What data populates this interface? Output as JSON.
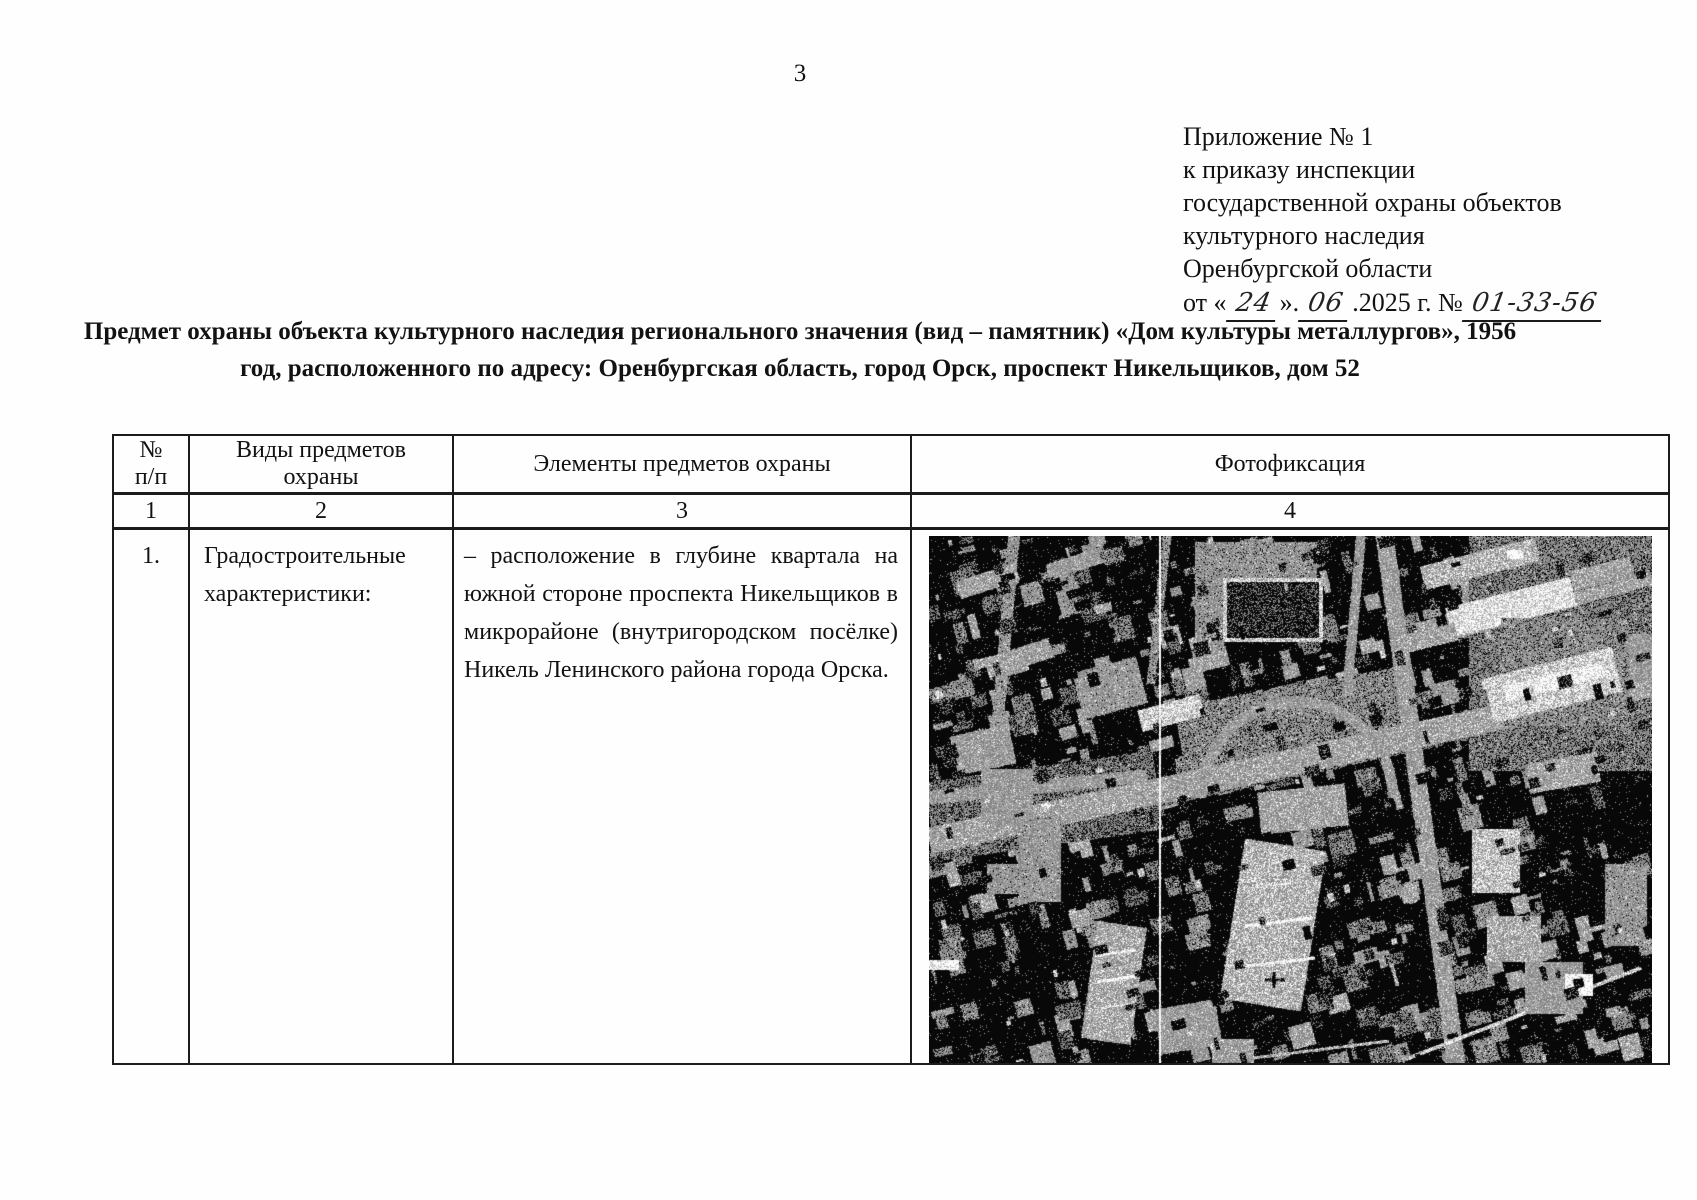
{
  "page": {
    "number": "3"
  },
  "header_block": {
    "lines": [
      "Приложение № 1",
      "к приказу инспекции",
      "государственной охраны объектов",
      "культурного наследия",
      "Оренбургской области"
    ],
    "date_line": {
      "pre": "от «",
      "day": "24",
      "mid1": "».",
      "month": "06",
      "mid2": ".2025 г. №",
      "number": "01-33-56"
    }
  },
  "title": {
    "line1": "Предмет охраны объекта культурного наследия регионального значения (вид – памятник) «Дом культуры металлургов»,  1956",
    "line2": "год, расположенного по адресу: Оренбургская область, город Орск, проспект Никельщиков, дом 52"
  },
  "table": {
    "headers": {
      "col1_line1": "№",
      "col1_line2": "п/п",
      "col2_line1": "Виды предметов",
      "col2_line2": "охраны",
      "col3": "Элементы предметов охраны",
      "col4": "Фотофиксация"
    },
    "numbers": [
      "1",
      "2",
      "3",
      "4"
    ],
    "row": {
      "num": "1.",
      "kind_lines": [
        "Градостроительные",
        "характеристики:"
      ],
      "element_lines": [
        "– расположение в глубине квартала на",
        "южной стороне проспекта Никельщиков в",
        "микрорайоне (внутригородском посёлке)",
        "Никель Ленинского района города Орска."
      ]
    }
  },
  "photo": {
    "width": 723,
    "height": 528,
    "seed": 987654321,
    "base": 0,
    "noise": 130,
    "salt": 0.05,
    "levels": [
      8,
      133,
      182,
      250
    ],
    "thresholds": [
      70,
      148,
      205
    ],
    "scanline_x": 230,
    "texture_passes": [
      {
        "stage": "under",
        "count": 560,
        "min": 3,
        "max": 26,
        "cmin": 70,
        "cmax": 160,
        "rot": -15
      },
      {
        "stage": "over",
        "count": 260,
        "min": 3,
        "max": 16,
        "cmin": 0,
        "cmax": 70,
        "rot": -15
      },
      {
        "stage": "over",
        "count": 70,
        "min": 2,
        "max": 9,
        "cmin": 150,
        "cmax": 205,
        "rot": -15
      }
    ],
    "features": [
      {
        "t": "rect",
        "x": 540,
        "y": 0,
        "w": 183,
        "h": 235,
        "r": 0,
        "c": 100
      },
      {
        "t": "rect",
        "x": 250,
        "y": 150,
        "w": 230,
        "h": 80,
        "r": -10,
        "c": 110
      },
      {
        "t": "rect",
        "x": 0,
        "y": 230,
        "w": 230,
        "h": 80,
        "r": -8,
        "c": 90
      },
      {
        "t": "line",
        "x1": 0,
        "y1": 318,
        "x2": 723,
        "y2": 161,
        "w": 6,
        "c": 95
      },
      {
        "t": "line",
        "x1": 0,
        "y1": 305,
        "x2": 723,
        "y2": 148,
        "w": 26,
        "c": 150
      },
      {
        "t": "line",
        "x1": 455,
        "y1": -5,
        "x2": 528,
        "y2": 533,
        "w": 18,
        "c": 145
      },
      {
        "t": "line",
        "x1": 85,
        "y1": 0,
        "x2": 68,
        "y2": 195,
        "w": 12,
        "c": 130
      },
      {
        "t": "line",
        "x1": 238,
        "y1": 0,
        "x2": 222,
        "y2": 148,
        "w": 9,
        "c": 120
      },
      {
        "t": "line",
        "x1": 0,
        "y1": 262,
        "x2": 218,
        "y2": 240,
        "w": 13,
        "c": 140
      },
      {
        "t": "line",
        "x1": 520,
        "y1": 98,
        "x2": 723,
        "y2": 42,
        "w": 13,
        "c": 150
      },
      {
        "t": "line",
        "x1": 432,
        "y1": 0,
        "x2": 418,
        "y2": 160,
        "w": 10,
        "c": 135
      },
      {
        "t": "line",
        "x1": 480,
        "y1": 522,
        "x2": 712,
        "y2": 432,
        "w": 4,
        "c": 195
      },
      {
        "t": "line",
        "x1": 300,
        "y1": 525,
        "x2": 460,
        "y2": 505,
        "w": 3,
        "c": 170
      },
      {
        "t": "arc",
        "cx": 368,
        "cy": 262,
        "r": 96,
        "a0": 180,
        "a1": 360,
        "w": 11,
        "c": 140
      },
      {
        "t": "rect",
        "x": 330,
        "y": 252,
        "w": 88,
        "h": 42,
        "r": -6,
        "c": 150
      },
      {
        "t": "rect",
        "x": 303,
        "y": 308,
        "w": 82,
        "h": 162,
        "r": 9,
        "c": 168
      },
      {
        "t": "line",
        "x1": 316,
        "y1": 390,
        "x2": 384,
        "y2": 382,
        "w": 3,
        "c": 255
      },
      {
        "t": "line",
        "x1": 318,
        "y1": 430,
        "x2": 386,
        "y2": 422,
        "w": 3,
        "c": 245
      },
      {
        "t": "line",
        "x1": 322,
        "y1": 352,
        "x2": 362,
        "y2": 347,
        "w": 2,
        "c": 225
      },
      {
        "t": "line",
        "x1": 345,
        "y1": 436,
        "x2": 345,
        "y2": 452,
        "w": 3,
        "c": 15
      },
      {
        "t": "line",
        "x1": 336,
        "y1": 444,
        "x2": 356,
        "y2": 444,
        "w": 3,
        "c": 15
      },
      {
        "t": "rect",
        "x": 28,
        "y": 36,
        "w": 62,
        "h": 18,
        "r": -18,
        "c": 150
      },
      {
        "t": "rect",
        "x": 118,
        "y": 20,
        "w": 54,
        "h": 16,
        "r": -18,
        "c": 140
      },
      {
        "t": "rect",
        "x": 56,
        "y": 112,
        "w": 68,
        "h": 20,
        "r": -18,
        "c": 148
      },
      {
        "t": "rect",
        "x": 148,
        "y": 128,
        "w": 66,
        "h": 48,
        "r": -15,
        "c": 132
      },
      {
        "t": "rect",
        "x": 24,
        "y": 194,
        "w": 60,
        "h": 40,
        "r": -12,
        "c": 142
      },
      {
        "t": "rect",
        "x": 210,
        "y": 166,
        "w": 64,
        "h": 22,
        "r": -15,
        "c": 198
      },
      {
        "t": "rect",
        "x": 260,
        "y": 118,
        "w": 40,
        "h": 16,
        "r": -15,
        "c": 148
      },
      {
        "t": "rect",
        "x": 52,
        "y": 233,
        "w": 52,
        "h": 56,
        "r": 0,
        "c": 138
      },
      {
        "t": "rect",
        "x": 90,
        "y": 280,
        "w": 42,
        "h": 86,
        "r": 0,
        "c": 132
      },
      {
        "t": "rect",
        "x": 266,
        "y": 6,
        "w": 122,
        "h": 96,
        "r": 0,
        "c": 125
      },
      {
        "t": "rect",
        "x": 298,
        "y": 46,
        "w": 92,
        "h": 56,
        "r": 0,
        "c": 40
      },
      {
        "t": "frame",
        "x": 296,
        "y": 44,
        "w": 96,
        "h": 60,
        "r": 0,
        "c": 195,
        "w2": 4
      },
      {
        "t": "rect",
        "x": 492,
        "y": 16,
        "w": 118,
        "h": 24,
        "r": -14,
        "c": 168
      },
      {
        "t": "rect",
        "x": 518,
        "y": 56,
        "w": 128,
        "h": 30,
        "r": -14,
        "c": 212
      },
      {
        "t": "rect",
        "x": 466,
        "y": 94,
        "w": 62,
        "h": 18,
        "r": -14,
        "c": 150
      },
      {
        "t": "rect",
        "x": 642,
        "y": 28,
        "w": 62,
        "h": 20,
        "r": -14,
        "c": 150
      },
      {
        "t": "rect",
        "x": 678,
        "y": 98,
        "w": 45,
        "h": 48,
        "r": 0,
        "c": 140
      },
      {
        "t": "rect",
        "x": 578,
        "y": 14,
        "w": 16,
        "h": 9,
        "r": 0,
        "c": 250
      },
      {
        "t": "rect",
        "x": 572,
        "y": 82,
        "w": 128,
        "h": 108,
        "r": 0,
        "c": 115
      },
      {
        "t": "rect",
        "x": 558,
        "y": 126,
        "w": 132,
        "h": 46,
        "r": -14,
        "c": 192
      },
      {
        "t": "rect",
        "x": 574,
        "y": 138,
        "w": 102,
        "h": 15,
        "r": -14,
        "c": 238
      },
      {
        "t": "rect",
        "x": 598,
        "y": 222,
        "w": 72,
        "h": 30,
        "r": -10,
        "c": 150
      },
      {
        "t": "rect",
        "x": 543,
        "y": 293,
        "w": 48,
        "h": 64,
        "r": 0,
        "c": 182
      },
      {
        "t": "rect",
        "x": 558,
        "y": 380,
        "w": 54,
        "h": 46,
        "r": 0,
        "c": 158
      },
      {
        "t": "rect",
        "x": 596,
        "y": 426,
        "w": 58,
        "h": 52,
        "r": 0,
        "c": 138
      },
      {
        "t": "rect",
        "x": 636,
        "y": 438,
        "w": 28,
        "h": 22,
        "r": 0,
        "c": 248
      },
      {
        "t": "rect",
        "x": 650,
        "y": 446,
        "w": 14,
        "h": 11,
        "r": 0,
        "c": 255
      },
      {
        "t": "rect",
        "x": 676,
        "y": 328,
        "w": 42,
        "h": 82,
        "r": 0,
        "c": 128
      },
      {
        "t": "rect",
        "x": 160,
        "y": 388,
        "w": 50,
        "h": 118,
        "r": 8,
        "c": 158
      },
      {
        "t": "line",
        "x1": 166,
        "y1": 420,
        "x2": 206,
        "y2": 414,
        "w": 3,
        "c": 240
      },
      {
        "t": "line",
        "x1": 168,
        "y1": 446,
        "x2": 208,
        "y2": 440,
        "w": 3,
        "c": 250
      },
      {
        "t": "line",
        "x1": 171,
        "y1": 472,
        "x2": 209,
        "y2": 467,
        "w": 2,
        "c": 228
      },
      {
        "t": "rect",
        "x": 58,
        "y": 328,
        "w": 42,
        "h": 30,
        "r": 0,
        "c": 130
      },
      {
        "t": "rect",
        "x": 228,
        "y": 468,
        "w": 62,
        "h": 46,
        "r": -10,
        "c": 140
      },
      {
        "t": "rect",
        "x": 283,
        "y": 503,
        "w": 42,
        "h": 24,
        "r": 0,
        "c": 148
      },
      {
        "t": "rect",
        "x": 0,
        "y": 424,
        "w": 30,
        "h": 10,
        "r": 0,
        "c": 235
      }
    ]
  }
}
